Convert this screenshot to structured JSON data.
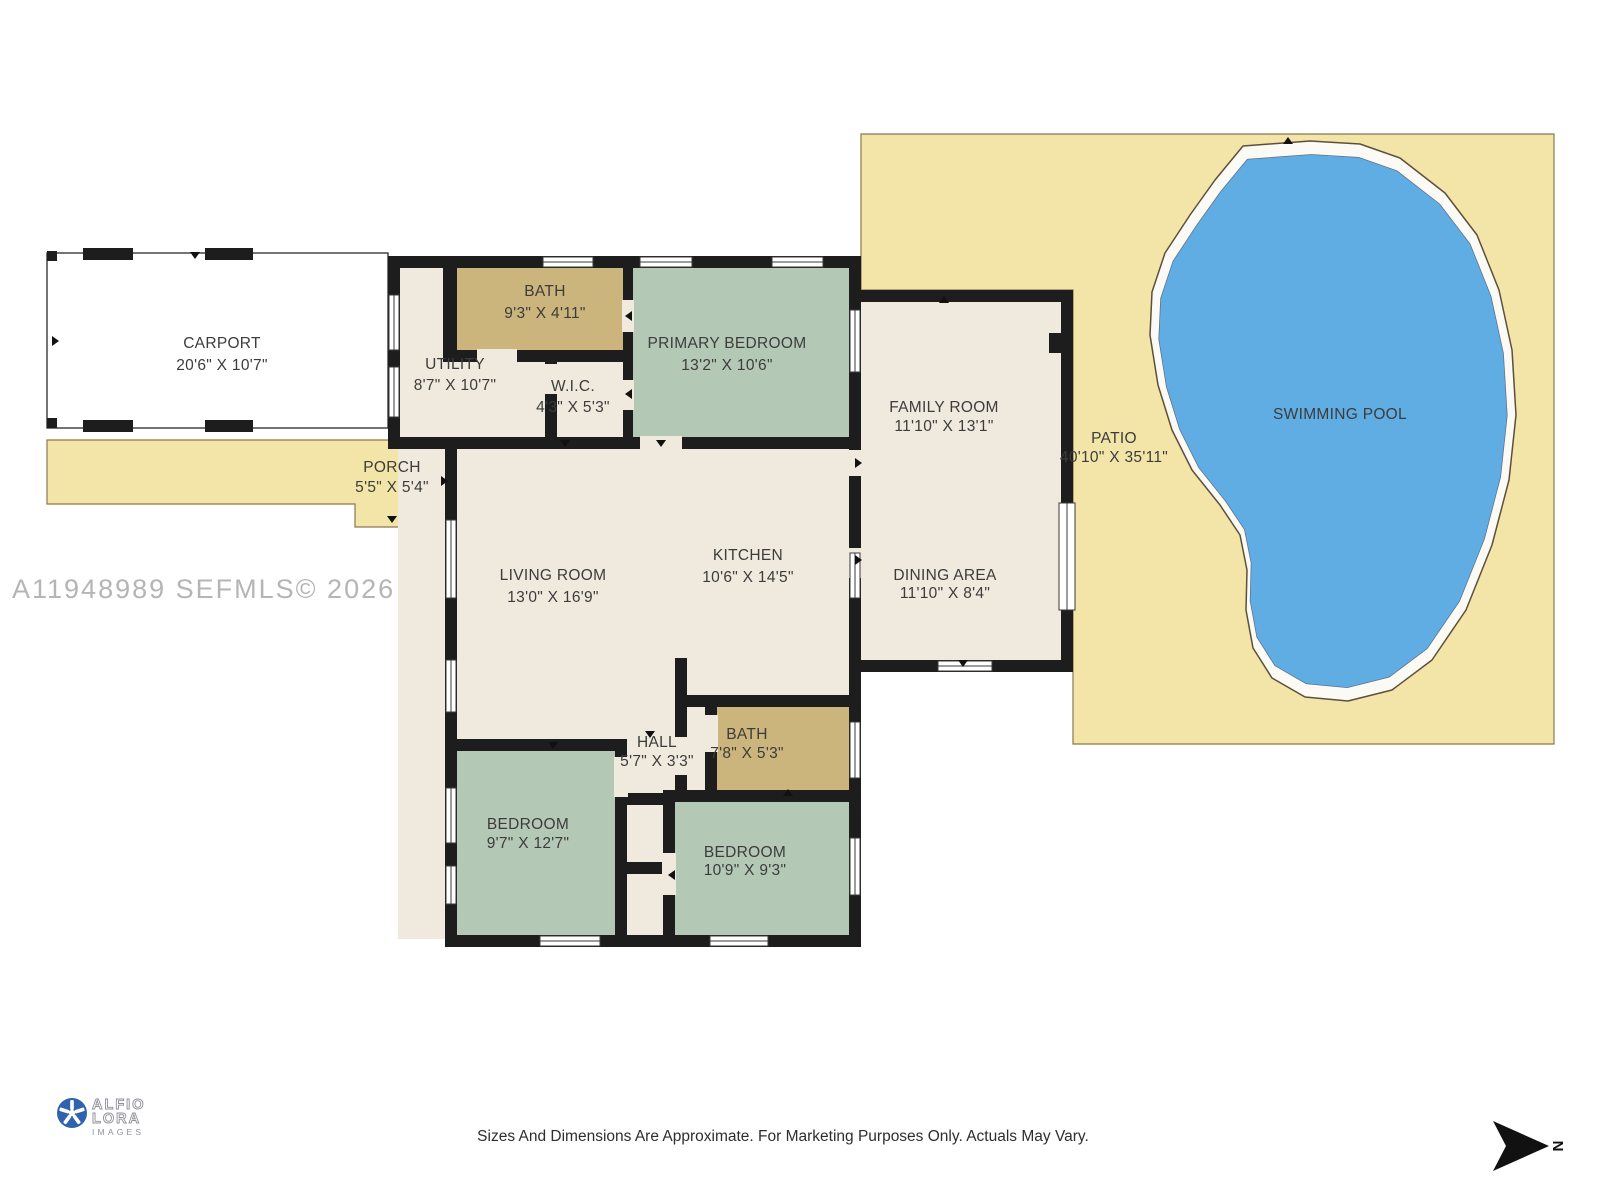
{
  "palette": {
    "wall": "#1d1d1d",
    "floor": "#f0e9dd",
    "bath": "#cbb57c",
    "bedroom": "#b4c8b6",
    "patio": "#f2e5a7",
    "pool": "#60ade3",
    "pooldeck": "#fbfaf5",
    "outline": "#6b5c41",
    "label": "#3c3c3c",
    "watermark": "#b5b5b5",
    "logoblue": "#2f63ad",
    "logogray": "#90909a"
  },
  "watermark": "A11948989  SEFMLS© 2026",
  "footer": "Sizes And Dimensions Are Approximate. For Marketing Purposes Only. Actuals May Vary.",
  "logo": {
    "line1": "ALFIO",
    "line2": "LORA",
    "line3": "IMAGES"
  },
  "compass": {
    "label": "N"
  },
  "rooms": {
    "carport": {
      "name": "CARPORT",
      "dims": "20'6\" X 10'7\""
    },
    "porch": {
      "name": "PORCH",
      "dims": "5'5\" X 5'4\""
    },
    "utility": {
      "name": "UTILITY",
      "dims": "8'7\" X 10'7\""
    },
    "bath1": {
      "name": "BATH",
      "dims": "9'3\" X 4'11\""
    },
    "wic": {
      "name": "W.I.C.",
      "dims": "4'3\" X 5'3\""
    },
    "primary_bedroom": {
      "name": "PRIMARY BEDROOM",
      "dims": "13'2\" X 10'6\""
    },
    "living_room": {
      "name": "LIVING ROOM",
      "dims": "13'0\" X 16'9\""
    },
    "kitchen": {
      "name": "KITCHEN",
      "dims": "10'6\" X 14'5\""
    },
    "family_room": {
      "name": "FAMILY ROOM",
      "dims": "11'10\" X 13'1\""
    },
    "dining_area": {
      "name": "DINING AREA",
      "dims": "11'10\" X 8'4\""
    },
    "patio": {
      "name": "PATIO",
      "dims": "40'10\" X 35'11\""
    },
    "swimming_pool": {
      "name": "SWIMMING POOL"
    },
    "hall": {
      "name": "HALL",
      "dims": "5'7\" X 3'3\""
    },
    "bath2": {
      "name": "BATH",
      "dims": "7'8\" X 5'3\""
    },
    "bedroom_left": {
      "name": "BEDROOM",
      "dims": "9'7\" X 12'7\""
    },
    "bedroom_right": {
      "name": "BEDROOM",
      "dims": "10'9\" X 9'3\""
    }
  }
}
